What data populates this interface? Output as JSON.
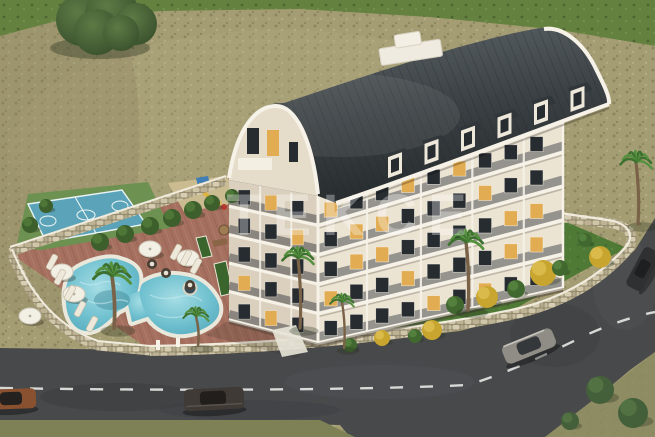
{
  "title": "Aerial 3D architectural rendering of a residential apartment complex",
  "watermark": {
    "text": "TEKCE"
  },
  "scene": {
    "building": {
      "floors_visible": 5,
      "dormer_count": 6,
      "roof_type": "curved-barrel"
    },
    "amenities": [
      "swimming-pool",
      "basketball-court",
      "playground",
      "sun-terrace",
      "garden"
    ],
    "vehicle_count": 4
  },
  "palette": {
    "grass_field": "#64813f",
    "scrub": "#a49c73",
    "scrub_dark": "#8d8562",
    "scrub_light": "#b9b089",
    "tree_green": "#45603a",
    "roof_dark": "#2f3437",
    "roof_light": "#5a6165",
    "facade_light": "#ece4d3",
    "facade_shadow": "#dbd0bd",
    "trim_white": "#f6f2e8",
    "window_dark": "#272c31",
    "window_lit": "#e2ac52",
    "pool_water": "#4fa4b8",
    "pool_water_light": "#a5dde4",
    "pool_deck": "#eae7db",
    "paving": "#a5705f",
    "paving_dark": "#8a5d4f",
    "court_blue": "#5ba3b8",
    "court_green": "#6d9150",
    "lawn": "#4e7a36",
    "bush_green": "#41682f",
    "bush_yellow": "#c7a52f",
    "stone_wall": "#c2b89b",
    "wall_coping": "#f0ebdc",
    "road": "#48494b",
    "road_marking": "#e8e8e4",
    "watermark_color": "rgba(255,255,255,0.32)"
  }
}
